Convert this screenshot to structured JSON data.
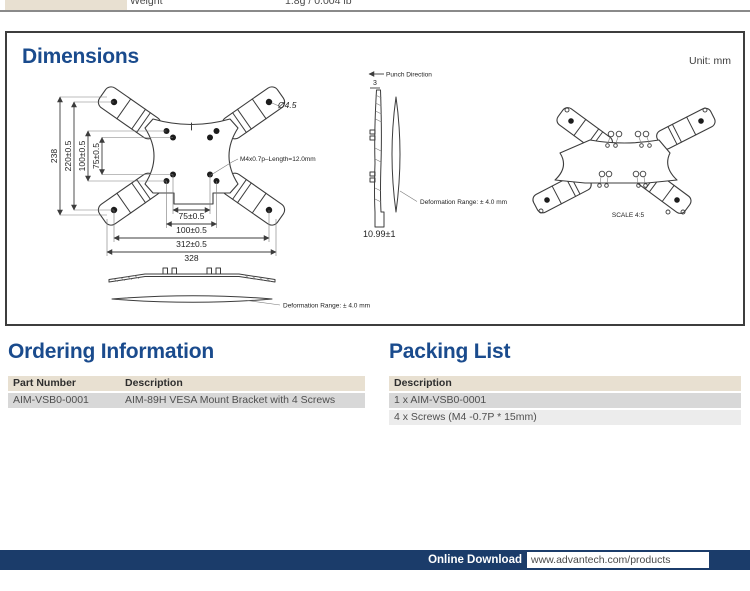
{
  "spec_row": {
    "label": "Weight",
    "value": "1.8g / 0.004 lb"
  },
  "dimensions": {
    "title": "Dimensions",
    "unit_note": "Unit: mm",
    "front_view": {
      "dim_238": "238",
      "dim_220": "220±0.5",
      "dim_100_v": "100±0.5",
      "dim_75_v": "75±0.5",
      "dim_75_h": "75±0.5",
      "dim_100_h": "100±0.5",
      "dim_312": "312±0.5",
      "dim_328": "328",
      "hole_dia": "Ø4.5",
      "thread": "M4x0.7p–Length=12.0mm"
    },
    "side_view": {
      "punch": "Punch Direction",
      "thickness": "3",
      "height": "10.99±1",
      "deformation": "Deformation Range: ± 4.0 mm"
    },
    "bottom_view": {
      "deformation": "Deformation Range: ± 4.0 mm"
    },
    "rear_view": {
      "scale": "SCALE 4:5"
    }
  },
  "ordering": {
    "title": "Ordering Information",
    "headers": [
      "Part Number",
      "Description"
    ],
    "rows": [
      [
        "AIM-VSB0-0001",
        "AIM-89H VESA Mount Bracket with 4 Screws"
      ]
    ]
  },
  "packing": {
    "title": "Packing List",
    "headers": [
      "Description"
    ],
    "rows": [
      "1 x AIM-VSB0-0001",
      "4 x Screws (M4 -0.7P * 15mm)"
    ]
  },
  "footer": {
    "label": "Online Download",
    "url": "www.advantech.com/products"
  },
  "colors": {
    "heading_navy": "#1a4b8d",
    "footer_navy": "#1b3c6a",
    "table_header_beige": "#e8e0d1",
    "row_gray": "#d8d8d8",
    "row_light_gray": "#ececec"
  }
}
